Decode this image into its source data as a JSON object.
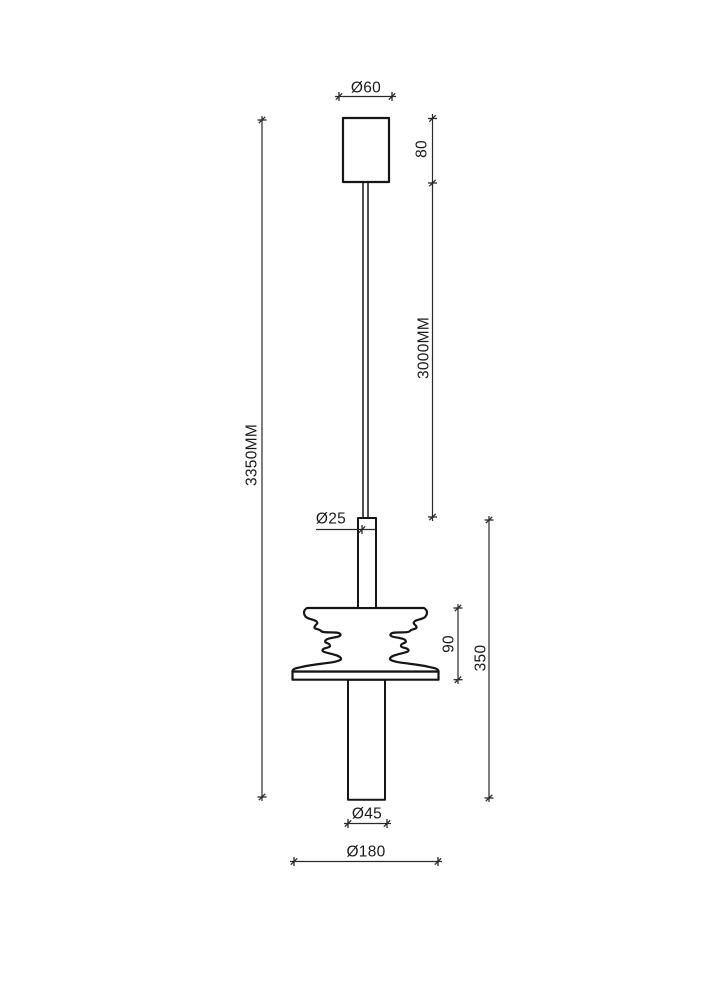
{
  "document": {
    "kind": "technical dimension drawing",
    "subject": "pendant lamp with wavy sound-wave shade",
    "background_color": "#ffffff",
    "object_line_color": "#161616",
    "dimension_line_color": "#2a2a2a",
    "text_color": "#1a1a1a"
  },
  "labels": {
    "canopy_diameter": "Ø60",
    "canopy_height": "80",
    "cord_length": "3000MM",
    "overall_height": "3350MM",
    "stem_diameter": "Ø25",
    "shade_height": "90",
    "body_height": "350",
    "tube_diameter": "Ø45",
    "shade_diameter": "Ø180"
  }
}
